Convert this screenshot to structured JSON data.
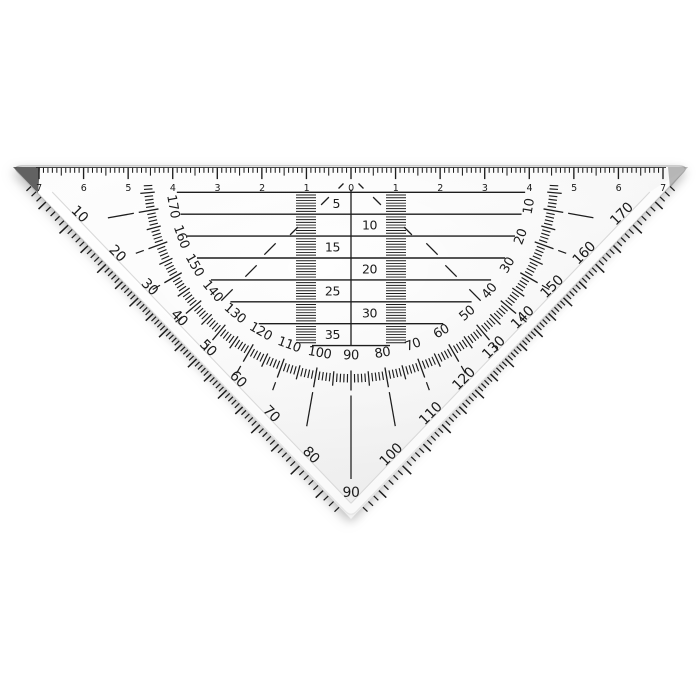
{
  "product": {
    "name": "transparent-protractor-set-square"
  },
  "colors": {
    "background": "#ffffff",
    "ink": "#1d1d1d",
    "body_edge": "#b7b7b7",
    "bevel_line": "#d9d9d9",
    "bevel_fill": "#ffffff",
    "body_light": "#fdfdfd",
    "body_mid": "#f6f6f6",
    "body_dark": "#ededed",
    "tip_shadow_left": "#474747",
    "tip_shadow_right": "#8b8b8b",
    "ruler_baseline": "#2a2a2a"
  },
  "ruler_scale": {
    "unit_numbers": [
      "7",
      "6",
      "5",
      "4",
      "3",
      "2",
      "1",
      "0",
      "1",
      "2",
      "3",
      "4",
      "5",
      "6",
      "7"
    ]
  },
  "parallel_guide_rows": {
    "labels": [
      "5",
      "10",
      "15",
      "20",
      "25",
      "30",
      "35"
    ]
  },
  "inner_degree_scale": {
    "labels": [
      "10",
      "20",
      "30",
      "40",
      "50",
      "60",
      "70",
      "80",
      "90",
      "100",
      "110",
      "120",
      "130",
      "140",
      "150",
      "160",
      "170"
    ]
  },
  "outer_degree_scale": {
    "labels": [
      "10",
      "20",
      "30",
      "40",
      "50",
      "60",
      "70",
      "80",
      "90",
      "100",
      "110",
      "120",
      "130",
      "140",
      "150",
      "160",
      "170"
    ]
  }
}
